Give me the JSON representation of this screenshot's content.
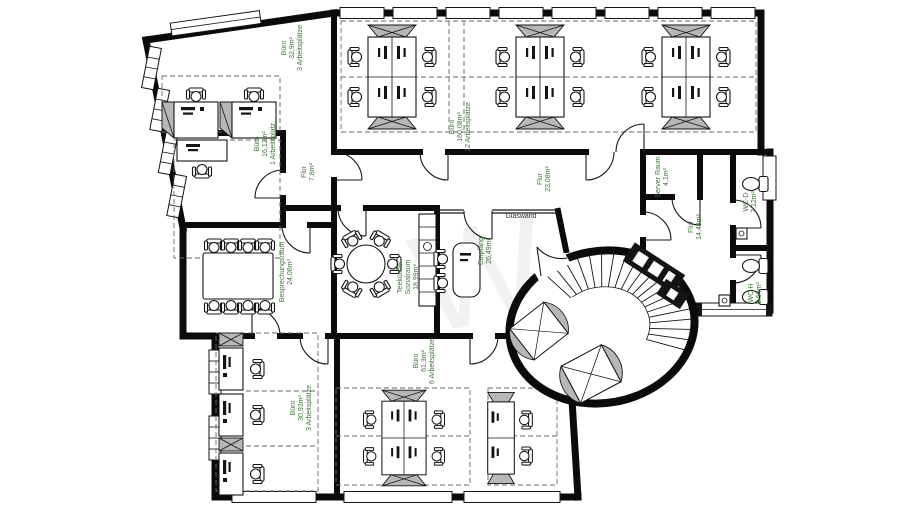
{
  "colors": {
    "label_green": "#3c7a35",
    "wall_black": "#0b0b0b",
    "cabinet_gray": "#b7b7b7",
    "background": "#ffffff"
  },
  "labels": {
    "buero_32": {
      "l1": "Büro",
      "l2": "32,9m²",
      "l3": "3 Arbeitsplätze"
    },
    "buero_16": {
      "l1": "Büro",
      "l2": "16,12m²",
      "l3": "1 Arbeitsplatz"
    },
    "flur_7": {
      "l1": "Flur",
      "l2": "7,8m²"
    },
    "buero_160": {
      "l1": "Büro",
      "l2": "160,08m²",
      "l3": "12 Arbeitsplätze"
    },
    "flur_23": {
      "l1": "Flur",
      "l2": "23,08m²"
    },
    "besprechungsraum": {
      "l1": "Besprechungsraum",
      "l2": "24,08m²"
    },
    "teekueche": {
      "l1": "Teeküche/",
      "l2": "Sozialraum",
      "l3": "18,99m²"
    },
    "empfang": {
      "l1": "Empfang",
      "l2": "26,49m²"
    },
    "glaswand": {
      "l1": "Glaswand"
    },
    "server_raum": {
      "l1": "Server Raum",
      "l2": "4,1m²"
    },
    "flur_14": {
      "l1": "Flur",
      "l2": "14,48m²"
    },
    "wc_d": {
      "l1": "WC-D",
      "l2": "7,12m²"
    },
    "wc_h": {
      "l1": "WC-H",
      "l2": "5,54m²"
    },
    "buero_30": {
      "l1": "Büro",
      "l2": "30,93m²",
      "l3": "3 Arbeitsplätze"
    },
    "buero_61": {
      "l1": "Büro",
      "l2": "61,3m²",
      "l3": "6 Arbeitsplätze"
    }
  }
}
